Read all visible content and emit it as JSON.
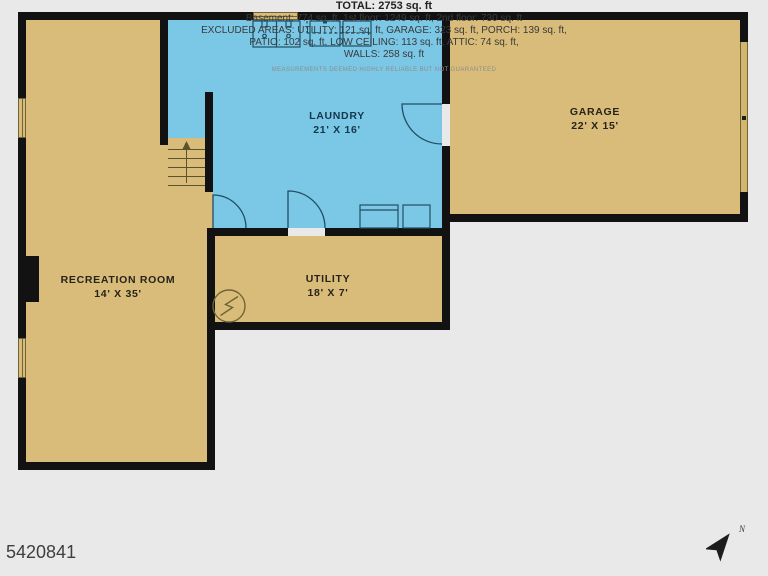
{
  "plan": {
    "rooms": [
      {
        "id": "laundry",
        "name": "LAUNDRY",
        "dims": "21' X 16'"
      },
      {
        "id": "garage",
        "name": "GARAGE",
        "dims": "22' X 15'"
      },
      {
        "id": "recreation",
        "name": "RECREATION ROOM",
        "dims": "14' X 35'"
      },
      {
        "id": "utility",
        "name": "UTILITY",
        "dims": "18' X 7'"
      }
    ],
    "fixtures": {
      "sink": "double-sink-icon",
      "laundry_units": "washer-dryer-icon",
      "stairs": "stairs-up-icon",
      "electrical": "electrical-panel-icon",
      "water_heater": "water-heater-icon",
      "doors": "door-swing-icon",
      "garage_door": "garage-door-icon"
    },
    "colors": {
      "floor_tan": "#d9bc79",
      "floor_blue": "#7bc7e6",
      "wall": "#121212",
      "background": "#e9e9e9"
    }
  },
  "summary": {
    "total": "TOTAL: 2753 sq. ft",
    "line1": "Basement: 774 sq. ft, 1st floor: 1249 sq. ft, 2nd floor: 730 sq. ft",
    "line2": "EXCLUDED AREAS: UTILITY: 121 sq. ft, GARAGE: 323 sq. ft, PORCH: 139 sq. ft,",
    "line3": "PATIO: 102 sq. ft, LOW CEILING: 113 sq. ft, ATTIC: 74 sq. ft,",
    "line4": "WALLS: 258 sq. ft",
    "disclaimer": "MEASUREMENTS DEEMED HIGHLY RELIABLE BUT NOT GUARANTEED"
  },
  "listing_id": "5420841",
  "compass": {
    "label": "N"
  }
}
